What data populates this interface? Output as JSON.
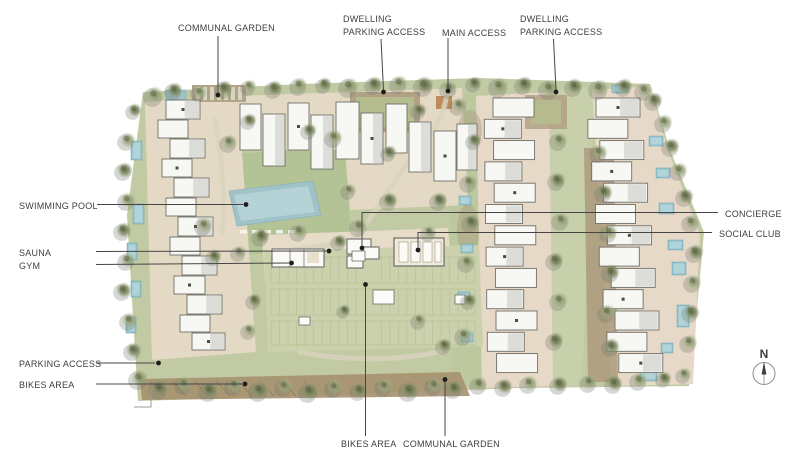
{
  "annotations": {
    "communal_garden_top": "COMMUNAL GARDEN",
    "dwelling_parking_access_left": {
      "line1": "DWELLING",
      "line2": "PARKING ACCESS"
    },
    "main_access": "MAIN ACCESS",
    "dwelling_parking_access_right": {
      "line1": "DWELLING",
      "line2": "PARKING ACCESS"
    },
    "swimming_pool": "SWIMMING POOL",
    "sauna": "SAUNA",
    "gym": "GYM",
    "concierge": "CONCIERGE",
    "social_club": "SOCIAL CLUB",
    "parking_access": "PARKING ACCESS",
    "bikes_area_left": "BIKES AREA",
    "bikes_area_bottom": "BIKES AREA",
    "communal_garden_bottom": "COMMUNAL GARDEN"
  },
  "compass": {
    "label": "N"
  },
  "palette": {
    "site_green": "#c2caa4",
    "lawn_green": "#b3c295",
    "paving_tan": "#e4d9c5",
    "paving_pink": "#e7d9c8",
    "mulch_brown": "#ab9a7d",
    "pool_blue": "#9fc3c9",
    "building_white": "#f7f7f4",
    "leader_line": "#454545",
    "label_text": "#3e3e3e"
  }
}
